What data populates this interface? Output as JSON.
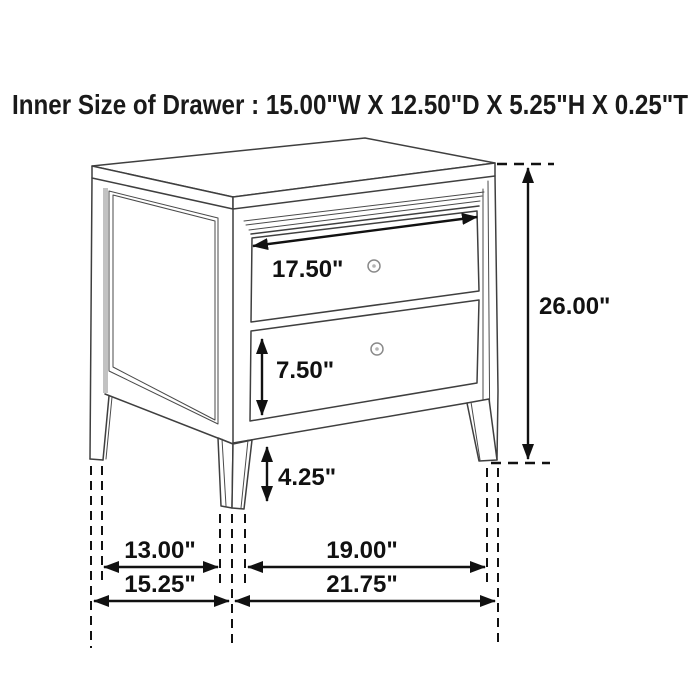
{
  "title": "Inner Size of Drawer : 15.00\"W X 12.50\"D X 5.25\"H X 0.25\"T",
  "dimensions": {
    "drawer_front_width": "17.50\"",
    "overall_height": "26.00\"",
    "bottom_drawer_height": "7.50\"",
    "leg_height": "4.25\"",
    "side_leg_spacing": "13.00\"",
    "side_overall_depth": "15.25\"",
    "front_leg_spacing": "19.00\"",
    "front_overall_width": "21.75\""
  },
  "colors": {
    "background": "#ffffff",
    "furniture_line": "#3f3f3f",
    "dimension_line": "#111111",
    "knob": "#8a8a8a",
    "shading": "#c2c2c2"
  }
}
